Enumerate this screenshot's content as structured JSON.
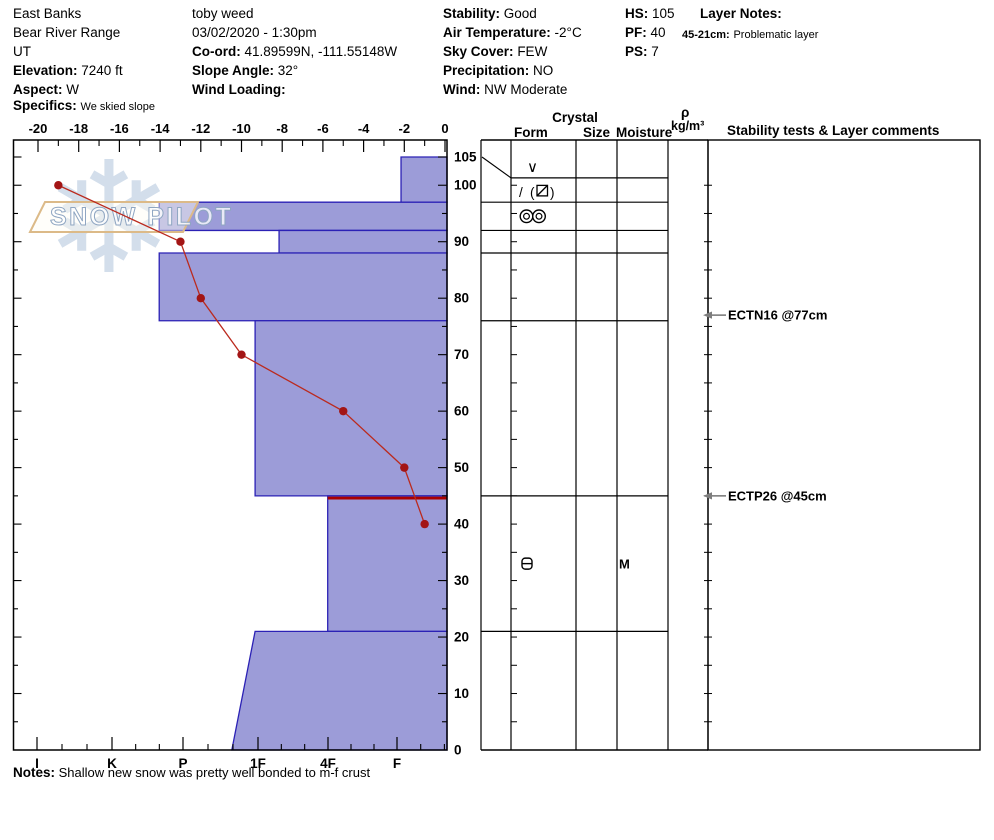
{
  "header": {
    "site": {
      "name": "East Banks",
      "range": "Bear River Range",
      "state": "UT",
      "elevation_label": "Elevation:",
      "elevation": "7240 ft",
      "aspect_label": "Aspect:",
      "aspect": "W",
      "specifics_label": "Specifics:",
      "specifics": "We skied slope"
    },
    "observer": {
      "name": "toby weed",
      "datetime": "03/02/2020 - 1:30pm",
      "coord_label": "Co-ord:",
      "coord": "41.89599N, -111.55148W",
      "slope_angle_label": "Slope Angle:",
      "slope_angle": "32°",
      "wind_loading_label": "Wind Loading:",
      "wind_loading": ""
    },
    "conditions": {
      "stability_label": "Stability:",
      "stability": "Good",
      "air_temp_label": "Air Temperature:",
      "air_temp": "-2°C",
      "sky_label": "Sky Cover:",
      "sky": "FEW",
      "precip_label": "Precipitation:",
      "precip": "NO",
      "wind_label": "Wind:",
      "wind": "NW Moderate"
    },
    "measures": {
      "hs_label": "HS:",
      "hs": "105",
      "pf_label": "PF:",
      "pf": "40",
      "ps_label": "PS:",
      "ps": "7"
    },
    "layer_notes": {
      "title": "Layer Notes:",
      "entry_label": "45-21cm:",
      "entry": "Problematic layer"
    }
  },
  "table_headers": {
    "crystal": "Crystal",
    "form": "Form",
    "size": "Size",
    "moisture": "Moisture",
    "rho": "ρ",
    "rho_units": "kg/m³",
    "comments": "Stability tests & Layer comments"
  },
  "watermark": {
    "text": "SNOW PILOT",
    "snowflake_glyph": "❄"
  },
  "notes": {
    "label": "Notes:",
    "text": "Shallow new snow was pretty well bonded to m-f crust"
  },
  "colors": {
    "bar_fill": "#9c9cd8",
    "bar_stroke": "#2b21b5",
    "temp_line": "#bb2a1e",
    "temp_dot": "#a31515",
    "problem_line": "#aa0000",
    "arrow_gray": "#7d7d7d",
    "watermark_flake": "#ccd9e8",
    "watermark_border": "#dcba88",
    "watermark_text_stroke": "#8fa6c2"
  },
  "chart_data": {
    "type": "snow-profile",
    "title": "Snow pit profile (SnowPilot) — hardness bars vs depth with temperature curve",
    "depth_axis": {
      "units": "cm",
      "max": 105,
      "labels": [
        0,
        10,
        20,
        30,
        40,
        50,
        60,
        70,
        80,
        90,
        100,
        105
      ]
    },
    "temp_axis": {
      "units": "°C",
      "ticks": [
        -20,
        -18,
        -16,
        -14,
        -12,
        -10,
        -8,
        -6,
        -4,
        -2,
        0
      ]
    },
    "hardness_axis": {
      "ticks": [
        "I",
        "K",
        "P",
        "1F",
        "4F",
        "F"
      ]
    },
    "layers": [
      {
        "top_cm": 105,
        "bottom_cm": 97,
        "hardness": "F",
        "h": 0.95
      },
      {
        "top_cm": 97,
        "bottom_cm": 92,
        "hardness": "P+",
        "h": 4.38
      },
      {
        "top_cm": 92,
        "bottom_cm": 88,
        "hardness": "1F-",
        "h": 2.68
      },
      {
        "top_cm": 88,
        "bottom_cm": 76,
        "hardness": "P+",
        "h": 4.38
      },
      {
        "top_cm": 76,
        "bottom_cm": 45,
        "hardness": "1F",
        "h": 3.02
      },
      {
        "top_cm": 45,
        "bottom_cm": 21,
        "hardness": "4F",
        "h": 1.99,
        "problem": true
      },
      {
        "top_cm": 21,
        "bottom_cm": 0,
        "hardness": "1F",
        "h": 3.02,
        "hardness_bottom": "1F+",
        "h_bottom": 3.35
      }
    ],
    "temperature_profile": [
      {
        "depth_cm": 100,
        "temp_c": -19
      },
      {
        "depth_cm": 90,
        "temp_c": -13
      },
      {
        "depth_cm": 80,
        "temp_c": -12
      },
      {
        "depth_cm": 70,
        "temp_c": -10
      },
      {
        "depth_cm": 60,
        "temp_c": -5
      },
      {
        "depth_cm": 50,
        "temp_c": -2
      },
      {
        "depth_cm": 40,
        "temp_c": -1
      }
    ],
    "layer_table": {
      "full_row_lines_cm": [
        97,
        92,
        88,
        76,
        45,
        21
      ],
      "partial_row_line_cm": 101.3,
      "surface_cm": 105,
      "crystal_forms": [
        {
          "symbol": "SH",
          "glyph": "∨",
          "place_cm": 103.2
        },
        {
          "symbol": "DF(FCxr)",
          "glyph": "/ (⧄)",
          "place_cm": 99.0
        },
        {
          "symbol": "MF",
          "glyph": "◎◎",
          "place_cm": 94.5
        },
        {
          "symbol": "MFcr",
          "glyph": "⊟",
          "place_cm": 33.0,
          "moisture": "M"
        }
      ]
    },
    "stability_tests": [
      {
        "text": "ECTN16 @77cm",
        "depth_cm": 77
      },
      {
        "text": "ECTP26 @45cm",
        "depth_cm": 45
      }
    ]
  }
}
